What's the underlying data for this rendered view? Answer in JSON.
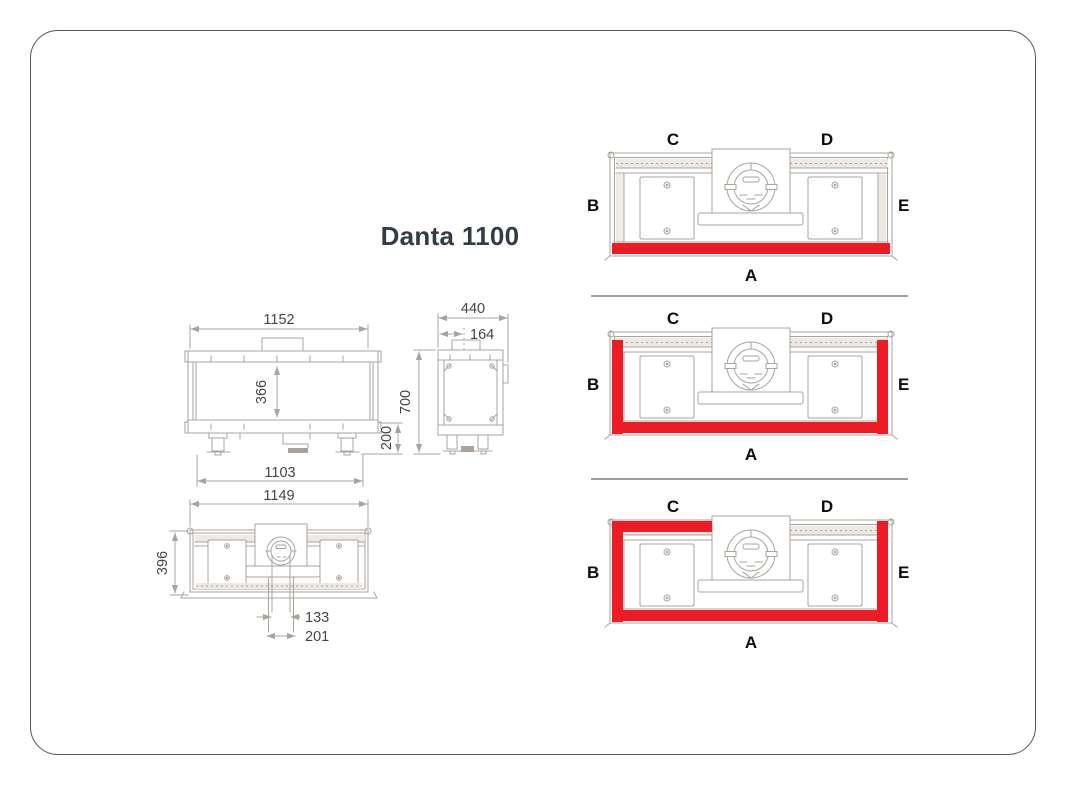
{
  "title": "Danta 1100",
  "colors": {
    "highlight_red": "#ed1c24",
    "drawing_line": "#aaa39c",
    "dimension_text": "#454545",
    "label_text": "#0d0d0d",
    "title_text": "#333b46",
    "divider": "#9d9d9d",
    "border": "#555555"
  },
  "dimensions": {
    "front_view": {
      "overall_width": "1152",
      "glass_height": "366",
      "base_height": "200",
      "lower_width": "1103"
    },
    "side_view": {
      "overall_depth": "440",
      "flue_offset": "164",
      "overall_height": "700"
    },
    "top_view": {
      "overall_width": "1149",
      "overall_depth": "396",
      "flue_offset_inner": "133",
      "flue_offset_outer": "201"
    }
  },
  "glazing_variants": [
    {
      "labels": {
        "top_left": "C",
        "top_right": "D",
        "left": "B",
        "right": "E",
        "bottom": "A"
      },
      "highlighted_sides": [
        "A"
      ]
    },
    {
      "labels": {
        "top_left": "C",
        "top_right": "D",
        "left": "B",
        "right": "E",
        "bottom": "A"
      },
      "highlighted_sides": [
        "B",
        "A",
        "E"
      ]
    },
    {
      "labels": {
        "top_left": "C",
        "top_right": "D",
        "left": "B",
        "right": "E",
        "bottom": "A"
      },
      "highlighted_sides": [
        "C",
        "B",
        "A",
        "E"
      ]
    }
  ]
}
